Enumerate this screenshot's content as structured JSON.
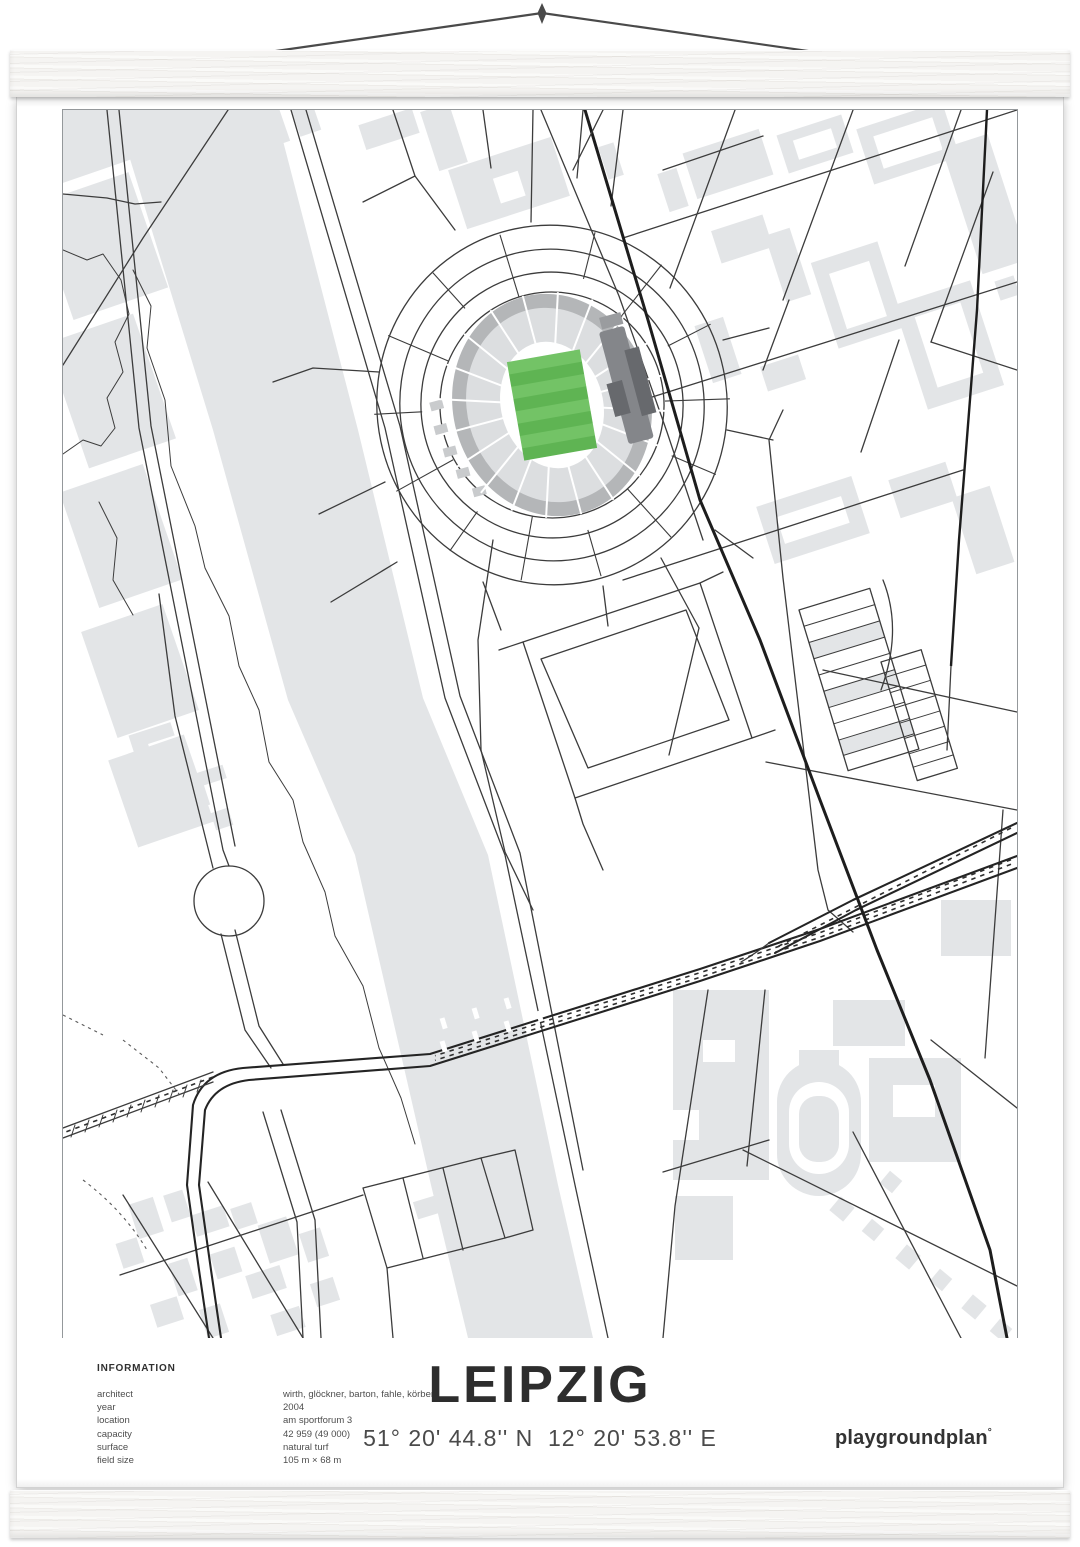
{
  "poster": {
    "title": "LEIPZIG",
    "coordinates": "51° 20' 44.8'' N  12° 20' 53.8'' E",
    "logo": {
      "text": "playgroundplan",
      "mark": "°"
    },
    "information": {
      "heading": "INFORMATION",
      "rows": [
        {
          "label": "architect",
          "value": "wirth, glöckner, barton, fahle, körber"
        },
        {
          "label": "year",
          "value": "2004"
        },
        {
          "label": "location",
          "value": "am sportforum 3"
        },
        {
          "label": "capacity",
          "value": "42 959 (49 000)"
        },
        {
          "label": "surface",
          "value": "natural turf"
        },
        {
          "label": "field size",
          "value": "105 m × 68 m"
        }
      ]
    }
  },
  "colors": {
    "pitch_green_light": "#73c366",
    "pitch_green_dark": "#5fb453",
    "map_gray": "#e3e5e7",
    "line_dark": "#3c3c3c",
    "stand_gray": "#b4b6b8",
    "text_dark": "#2e2e2e",
    "wood": "#f5f4f2"
  }
}
